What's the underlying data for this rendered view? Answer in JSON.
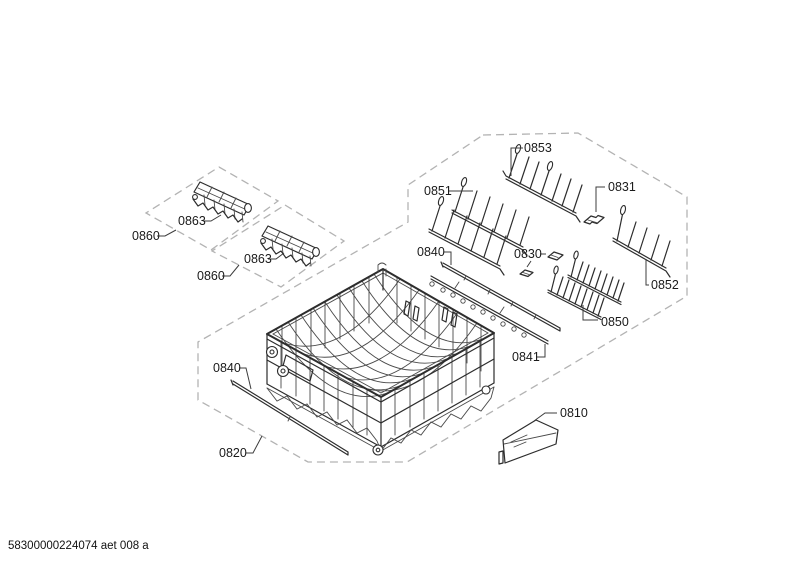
{
  "page": {
    "background": "#ffffff"
  },
  "footer": {
    "doc_code": "58300000224074 aet 008 a"
  },
  "colors": {
    "line": "#2d2d2d",
    "dashed_outline": "#b3b3b3",
    "label": "#1a1a1a",
    "background": "#ffffff"
  },
  "callouts": {
    "c0853": "0853",
    "c0851": "0851",
    "c0831": "0831",
    "c0840_top": "0840",
    "c0830": "0830",
    "c0852": "0852",
    "c0850": "0850",
    "c0841": "0841",
    "c0810": "0810",
    "c0820": "0820",
    "c0860_left": "0860",
    "c0863_left": "0863",
    "c0860_right": "0860",
    "c0863_right": "0863",
    "c0840_bottom": "0840"
  }
}
